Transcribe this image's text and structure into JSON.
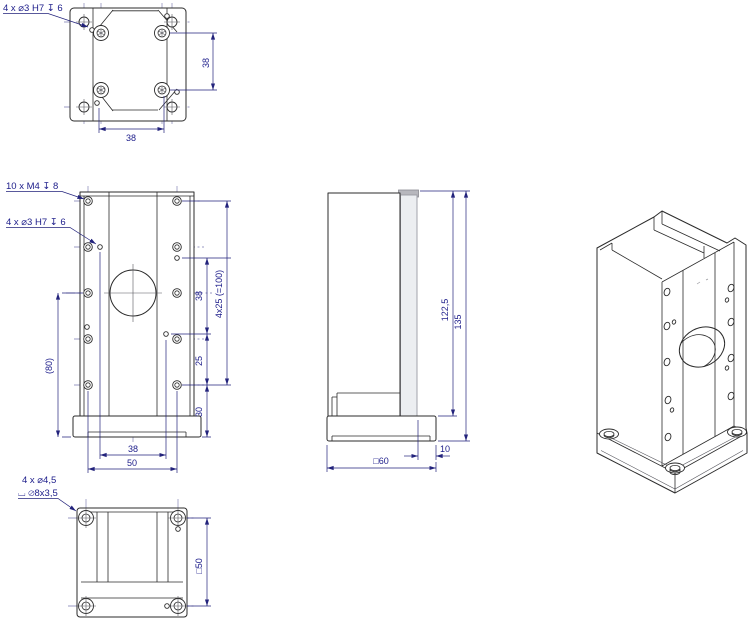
{
  "top_view": {
    "hole_callout": "4 x  ⌀3 H7 ↧ 6",
    "dim_row_spacing": "38",
    "dim_col_spacing": "38"
  },
  "front_view": {
    "thread_callout": "10 x M4 ↧ 8",
    "pin_callout": "4 x  ⌀3 H7 ↧ 6",
    "dim_pin_vertical": "38",
    "dim_pitch_chain": "4x25 (=100)",
    "dim_25": "25",
    "dim_30": "30",
    "dim_ref_height": "(80)",
    "dim_pin_horizontal": "38",
    "dim_hole_cols": "50"
  },
  "side_view": {
    "dim_height_to_base": "122,5",
    "dim_total_height": "135",
    "dim_plate_overhang": "10",
    "dim_base_square": "□60"
  },
  "bottom_view": {
    "callout_line1": "4 x  ⌀4,5",
    "callout_line2": "⌴ ⌀8x3,5",
    "dim_hole_square": "□50"
  },
  "colors": {
    "outline": "#2b2b2b",
    "dimension": "#1c1c8a",
    "centerline": "#7a7ab0",
    "carriage_gray": "#b7b7bd"
  }
}
